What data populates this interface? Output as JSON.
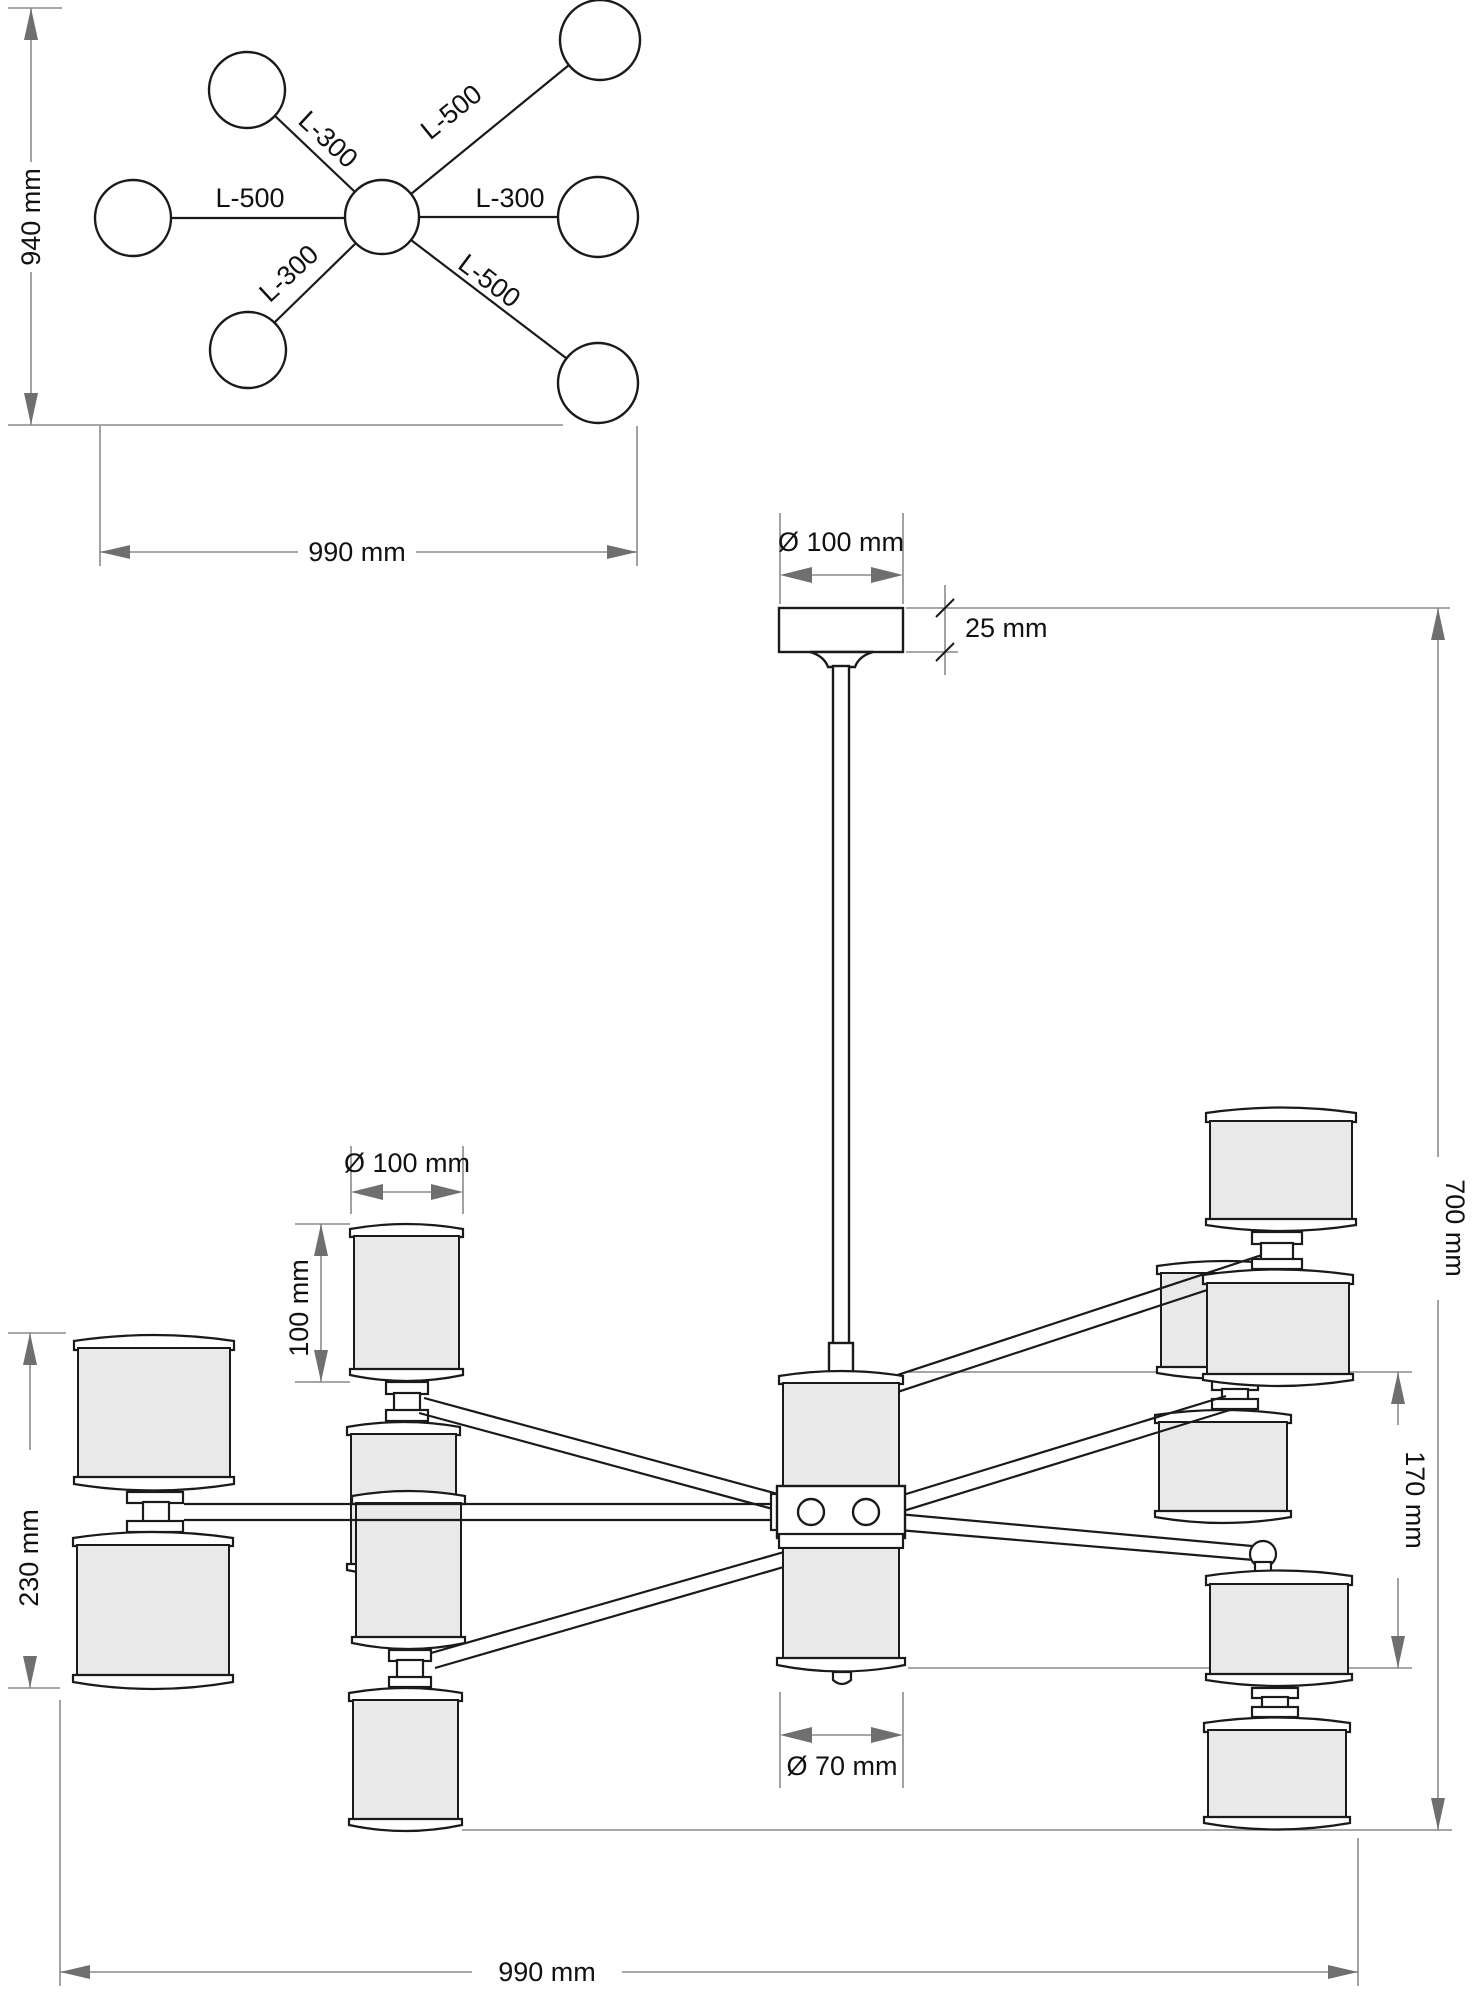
{
  "drawing": {
    "type": "chandelier-technical-dimension-drawing",
    "colors": {
      "line": "#1a1a1a",
      "dimension_line": "#8a8a8a",
      "arrow": "#6f6f6f",
      "shade_fill": "#e9e9e9",
      "background": "#ffffff"
    },
    "top_view": {
      "height_dim": "940 mm",
      "width_dim": "990 mm",
      "arms": {
        "upper_left": "L-300",
        "upper_right": "L-500",
        "left": "L-500",
        "right": "L-300",
        "lower_left": "L-300",
        "lower_right": "L-500"
      }
    },
    "side_view": {
      "canopy_diameter": "Ø 100 mm",
      "canopy_height": "25 mm",
      "overall_height": "700 mm",
      "shade_diameter": "Ø 100 mm",
      "shade_height": "100 mm",
      "side_pair_height": "230 mm",
      "center_cluster_height": "170 mm",
      "finial_diameter": "Ø 70 mm",
      "overall_width": "990 mm"
    }
  }
}
